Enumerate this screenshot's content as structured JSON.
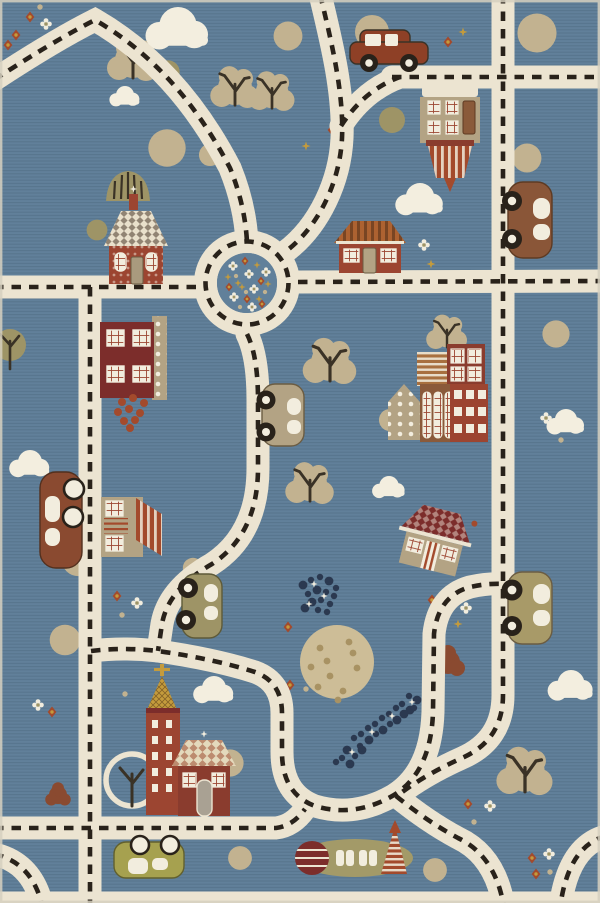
{
  "title": "children's road play rug",
  "palette": {
    "background": "#61809a",
    "road": "#ece4d1",
    "dash": "#29221a",
    "cloud": "#f3eedf",
    "tree_beige": "#c2b290",
    "tree_olive": "#9e9466",
    "foliage_rust": "#8a4a30",
    "wall_tan": "#b3a384",
    "brick": "#9c4531",
    "maroon": "#7c2d2b",
    "brown": "#8a5a3a",
    "ochre": "#ad6231",
    "gold": "#c49b3c",
    "rust": "#a34a2c",
    "navy": "#2b3950",
    "lime": "#a6a14f",
    "cream": "#f2edde",
    "moon": "#cdbd97",
    "edge": "#d6d0c0"
  },
  "scene": {
    "clouds": [
      [
        178,
        32,
        1.25
      ],
      [
        125,
        98,
        0.6
      ],
      [
        420,
        202,
        0.95
      ],
      [
        566,
        424,
        0.75
      ],
      [
        30,
        466,
        0.8
      ],
      [
        389,
        489,
        0.65
      ],
      [
        214,
        692,
        0.8
      ],
      [
        571,
        688,
        0.9
      ]
    ],
    "trees": [
      [
        133,
        60,
        "lobed",
        1
      ],
      [
        235,
        88,
        "lobed",
        0.95
      ],
      [
        272,
        92,
        "lobed",
        0.9
      ],
      [
        330,
        362,
        "lobed",
        1.05
      ],
      [
        310,
        484,
        "lobed",
        0.95
      ],
      [
        447,
        333,
        "lobed",
        0.8
      ],
      [
        525,
        772,
        "lobed",
        1.1
      ],
      [
        372,
        32,
        "round",
        1
      ],
      [
        537,
        33,
        "round",
        1.15
      ],
      [
        527,
        158,
        "round",
        0.85
      ],
      [
        390,
        420,
        "round",
        0.65
      ],
      [
        230,
        763,
        "round",
        0.8
      ],
      [
        240,
        858,
        "round",
        0.7
      ],
      [
        435,
        870,
        "round",
        0.7
      ],
      [
        78,
        560,
        "round",
        0.95
      ],
      [
        65,
        640,
        "round",
        0.9
      ],
      [
        167,
        148,
        "round",
        1.1
      ],
      [
        556,
        334,
        "round",
        0.8
      ],
      [
        288,
        36,
        "round",
        0.85
      ],
      [
        210,
        155,
        "round",
        0.65
      ],
      [
        193,
        568,
        "round",
        0.6
      ],
      [
        168,
        72,
        "olive",
        0.9
      ],
      [
        392,
        120,
        "olive",
        1
      ],
      [
        97,
        230,
        "olive",
        0.8
      ],
      [
        10,
        345,
        "olivebranch",
        1
      ],
      [
        128,
        187,
        "spiky",
        1
      ],
      [
        448,
        662,
        "rustblob",
        1
      ],
      [
        58,
        795,
        "rustblob",
        0.75
      ],
      [
        132,
        780,
        "ring",
        1
      ]
    ],
    "flowers": [
      [
        30,
        17,
        "rust"
      ],
      [
        46,
        24,
        "white"
      ],
      [
        16,
        35,
        "rust"
      ],
      [
        40,
        7,
        "tan"
      ],
      [
        8,
        45,
        "rust"
      ],
      [
        332,
        130,
        "rust"
      ],
      [
        306,
        146,
        "gold"
      ],
      [
        448,
        42,
        "rust"
      ],
      [
        463,
        32,
        "gold"
      ],
      [
        424,
        245,
        "white"
      ],
      [
        431,
        264,
        "gold"
      ],
      [
        546,
        418,
        "white"
      ],
      [
        561,
        440,
        "tan"
      ],
      [
        432,
        600,
        "rust"
      ],
      [
        466,
        608,
        "white"
      ],
      [
        458,
        624,
        "gold"
      ],
      [
        288,
        627,
        "rust"
      ],
      [
        290,
        685,
        "rust"
      ],
      [
        306,
        689,
        "tan"
      ],
      [
        117,
        596,
        "rust"
      ],
      [
        137,
        603,
        "white"
      ],
      [
        122,
        615,
        "tan"
      ],
      [
        125,
        694,
        "tan"
      ],
      [
        38,
        705,
        "white"
      ],
      [
        52,
        712,
        "rust"
      ],
      [
        468,
        804,
        "rust"
      ],
      [
        490,
        806,
        "white"
      ],
      [
        474,
        822,
        "tan"
      ],
      [
        532,
        858,
        "rust"
      ],
      [
        549,
        854,
        "white"
      ],
      [
        536,
        874,
        "rust"
      ],
      [
        550,
        872,
        "tan"
      ]
    ],
    "roundabout_flowers": [
      [
        233,
        266,
        "white"
      ],
      [
        245,
        261,
        "rust"
      ],
      [
        257,
        265,
        "gold"
      ],
      [
        266,
        272,
        "white"
      ],
      [
        236,
        276,
        "tan"
      ],
      [
        249,
        274,
        "white"
      ],
      [
        261,
        281,
        "rust"
      ],
      [
        229,
        287,
        "rust"
      ],
      [
        242,
        287,
        "gold"
      ],
      [
        254,
        289,
        "white"
      ],
      [
        265,
        292,
        "tan"
      ],
      [
        234,
        297,
        "white"
      ],
      [
        247,
        299,
        "rust"
      ],
      [
        259,
        299,
        "gold"
      ],
      [
        240,
        307,
        "tan"
      ],
      [
        252,
        307,
        "white"
      ],
      [
        262,
        304,
        "rust"
      ],
      [
        228,
        277,
        "gold"
      ],
      [
        268,
        284,
        "gold"
      ],
      [
        246,
        292,
        "tan"
      ],
      [
        238,
        283,
        "gold"
      ]
    ],
    "moon": {
      "cx": 337,
      "cy": 662,
      "r": 37,
      "specks": [
        [
          320,
          648
        ],
        [
          349,
          642
        ],
        [
          357,
          668
        ],
        [
          330,
          676
        ],
        [
          318,
          687
        ],
        [
          343,
          691
        ],
        [
          353,
          653
        ],
        [
          327,
          661
        ],
        [
          338,
          700
        ],
        [
          311,
          667
        ]
      ]
    },
    "dot_swarms": [
      {
        "dots": [
          [
            303,
            585
          ],
          [
            311,
            580
          ],
          [
            320,
            577
          ],
          [
            329,
            581
          ],
          [
            336,
            588
          ],
          [
            308,
            594
          ],
          [
            317,
            590
          ],
          [
            326,
            592
          ],
          [
            334,
            596
          ],
          [
            312,
            602
          ],
          [
            321,
            600
          ],
          [
            330,
            604
          ],
          [
            305,
            608
          ],
          [
            318,
            610
          ],
          [
            327,
            612
          ]
        ],
        "sparkles": [
          [
            314,
            584
          ],
          [
            324,
            596
          ],
          [
            309,
            604
          ]
        ]
      },
      {
        "dots": [
          [
            417,
            700
          ],
          [
            409,
            696
          ],
          [
            402,
            704
          ],
          [
            410,
            710
          ],
          [
            396,
            708
          ],
          [
            389,
            714
          ],
          [
            397,
            720
          ],
          [
            382,
            718
          ],
          [
            375,
            724
          ],
          [
            383,
            730
          ],
          [
            368,
            728
          ],
          [
            361,
            734
          ],
          [
            369,
            740
          ],
          [
            354,
            738
          ],
          [
            360,
            746
          ],
          [
            347,
            750
          ],
          [
            355,
            756
          ],
          [
            342,
            758
          ],
          [
            350,
            764
          ],
          [
            336,
            762
          ],
          [
            414,
            708
          ],
          [
            404,
            714
          ],
          [
            390,
            724
          ],
          [
            376,
            734
          ],
          [
            362,
            750
          ]
        ],
        "sparkles": [
          [
            412,
            702
          ],
          [
            392,
            716
          ],
          [
            372,
            732
          ],
          [
            352,
            752
          ]
        ]
      }
    ]
  }
}
